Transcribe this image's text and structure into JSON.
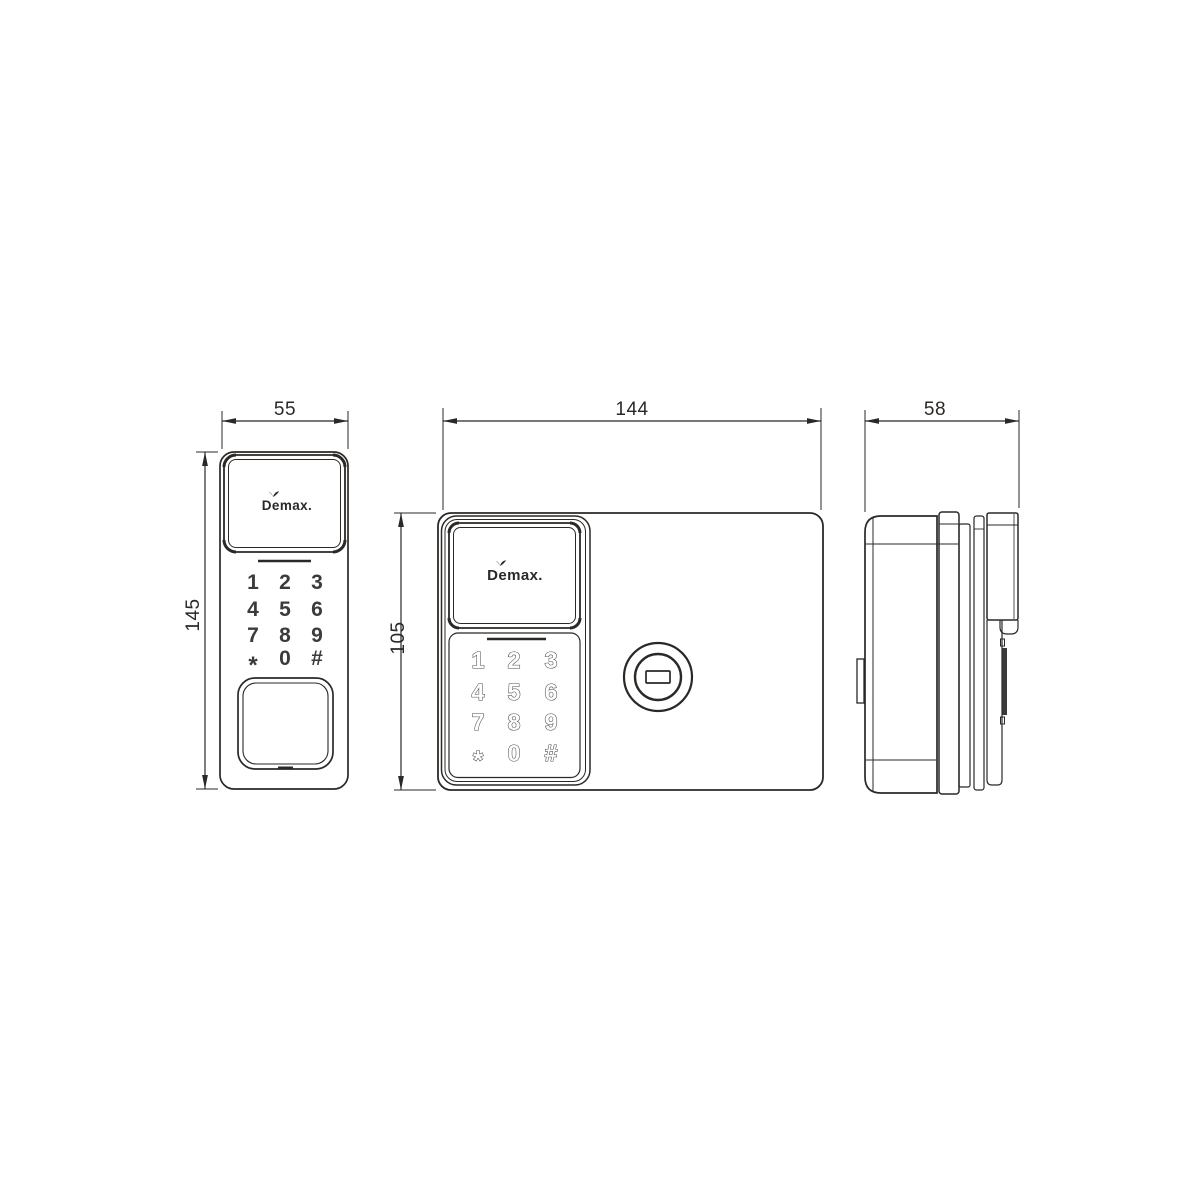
{
  "brand": "Demax.",
  "keypad": {
    "keys": [
      "1",
      "2",
      "3",
      "4",
      "5",
      "6",
      "7",
      "8",
      "9",
      "*",
      "0",
      "#"
    ]
  },
  "dimensions": {
    "front_width": "55",
    "front_height": "145",
    "main_width": "144",
    "main_height": "105",
    "side_width": "58"
  },
  "colors": {
    "line": "#2b2826",
    "background": "#ffffff",
    "dark_strip": "#3a3a3a"
  }
}
